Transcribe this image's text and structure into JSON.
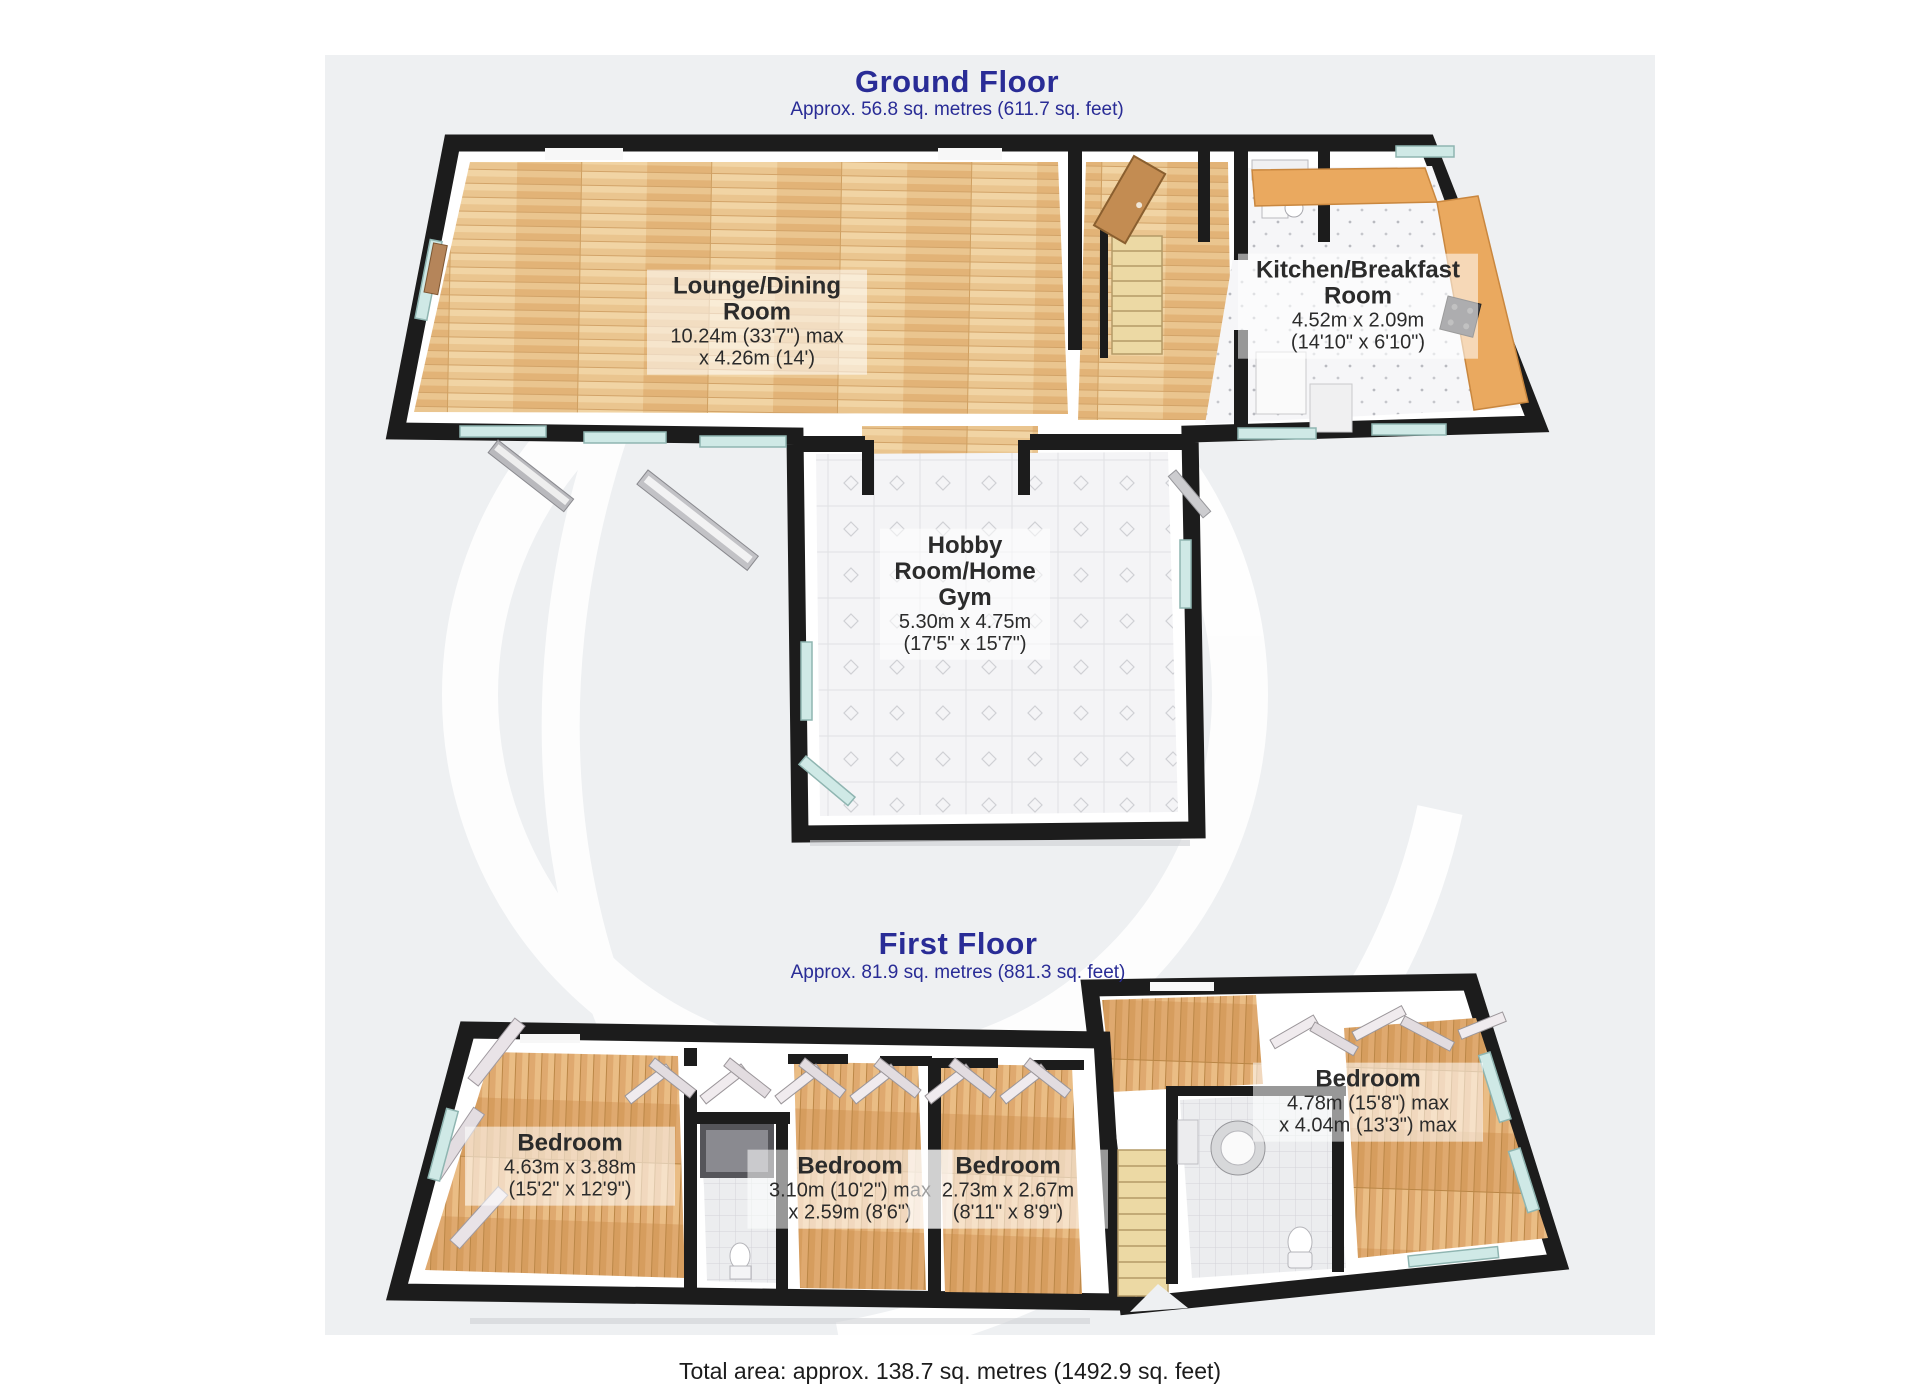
{
  "page": {
    "background": "#eef0f2",
    "title_color": "#292c96"
  },
  "ground_floor": {
    "title": "Ground Floor",
    "area": "Approx. 56.8 sq. metres (611.7 sq. feet)",
    "rooms": [
      {
        "name": "Lounge/Dining Room",
        "dims1": "10.24m (33'7\") max",
        "dims2": "x 4.26m (14')"
      },
      {
        "name": "Kitchen/Breakfast Room",
        "dims1": "4.52m x 2.09m",
        "dims2": "(14'10\" x 6'10\")"
      },
      {
        "name": "Hobby Room/Home Gym",
        "dims1": "5.30m x 4.75m",
        "dims2": "(17'5\" x 15'7\")"
      }
    ]
  },
  "first_floor": {
    "title": "First Floor",
    "area": "Approx. 81.9 sq. metres (881.3 sq. feet)",
    "rooms": [
      {
        "name": "Bedroom",
        "dims1": "4.63m x 3.88m",
        "dims2": "(15'2\" x 12'9\")"
      },
      {
        "name": "Bedroom",
        "dims1": "3.10m (10'2\") max",
        "dims2": "x 2.59m (8'6\")"
      },
      {
        "name": "Bedroom",
        "dims1": "2.73m x 2.67m",
        "dims2": "(8'11\" x 8'9\")"
      },
      {
        "name": "Bedroom",
        "dims1": "4.78m (15'8\") max",
        "dims2": "x 4.04m (13'3\") max"
      }
    ]
  },
  "total_area": "Total area: approx. 138.7 sq. metres (1492.9 sq. feet)",
  "colors": {
    "wall": "#1c1c1c",
    "wood_ground": "#eac58f",
    "wood_first": "#dfa96f",
    "counter": "#eaa95f",
    "window": "#cfe9e6",
    "stairs": "#ecd9a4",
    "label_text": "#2b2b2b"
  }
}
